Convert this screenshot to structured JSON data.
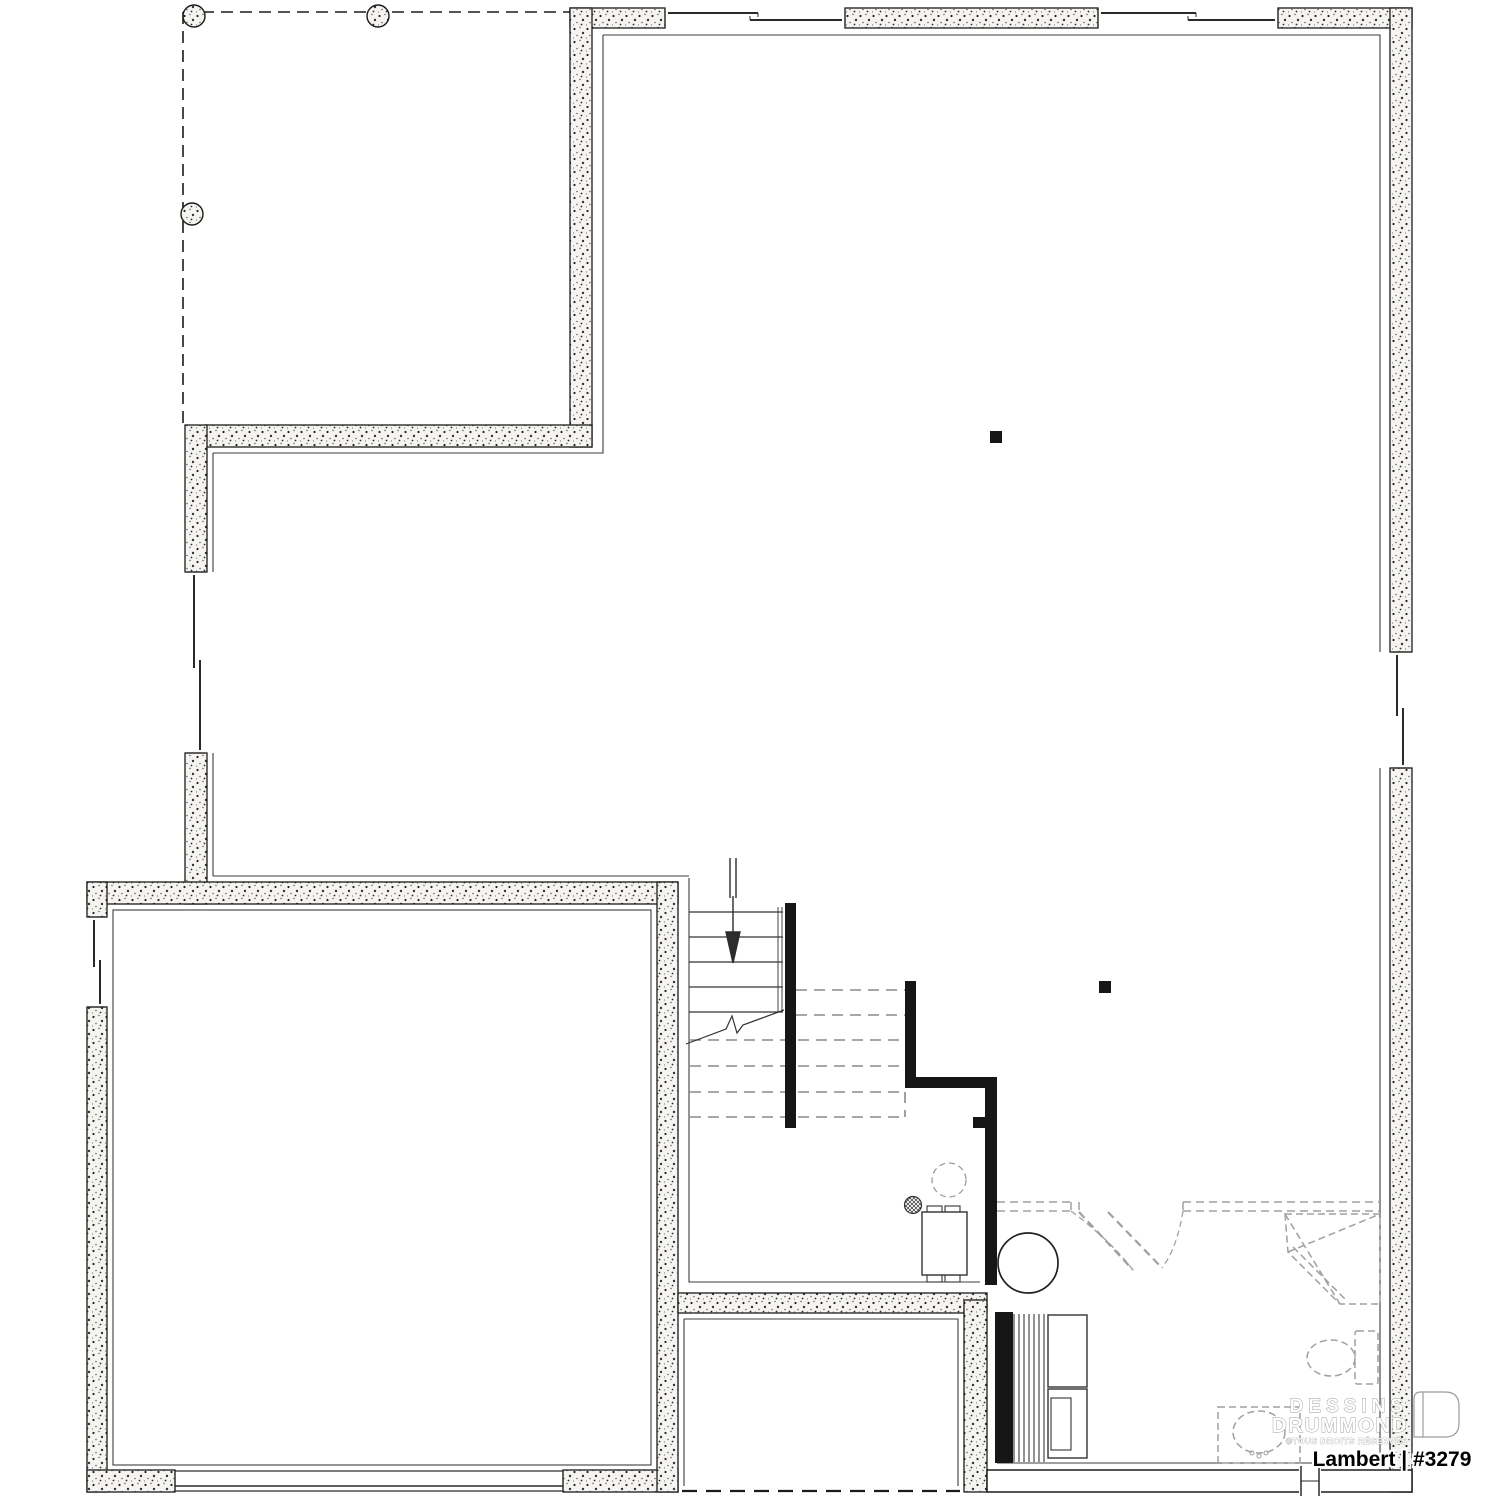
{
  "page": {
    "kind": "basement floor plan drawing",
    "background": "#ffffff"
  },
  "branding": {
    "watermark_line1": "DESSINS",
    "watermark_line2": "DRUMMOND",
    "watermark_line3": "©TOUS DROITS RÉSERVÉS",
    "logo_icon": "drummond-door-logo"
  },
  "title_block": {
    "plan_label": "Lambert | #3279"
  },
  "colors": {
    "wall_fill": "#f5f4f1",
    "wall_stroke": "#1b1b1b",
    "partition_black": "#161616",
    "fixture_dashed_gray": "#a0a0a0",
    "tread_dashed_gray": "#8a8a8a",
    "watermark_gray": "#9c9c9c"
  },
  "features": [
    "deck-footprint-dashed-outline",
    "deck-footing-piers (3)",
    "sliding-patio-doors (2, top wall)",
    "basement-windows (left, right, garage, rear)",
    "staircase-with-down-arrow-and-break-line",
    "steel-posts (2) and door-jamb-post",
    "furnace-unit",
    "floor-drain",
    "water-heater-tank",
    "future-equipment-dashed-circle",
    "shelved-closet",
    "washer-dryer-appliances",
    "future-bathroom: corner-shower, toilet, vanity-sink, double-door-swing",
    "garage-door-opening",
    "cold-room-under-porch"
  ]
}
